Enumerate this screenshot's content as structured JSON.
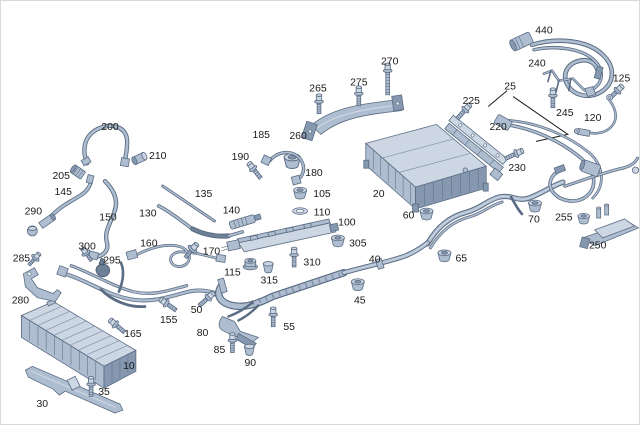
{
  "diagram": {
    "type": "exploded-parts-diagram",
    "colors": {
      "bg": "#ffffff",
      "label_color": "#1a1a1a",
      "leader_color": "#1a1a1a",
      "part_fill_light": "#ccd7e3",
      "part_fill_mid": "#aebdd0",
      "part_fill_dark": "#8598b0",
      "part_fill_darker": "#6e8096",
      "part_stroke": "#5a6c83",
      "hole_fill": "#eef2f6"
    },
    "callouts": [
      {
        "id": "440",
        "x": 545,
        "y": 29
      },
      {
        "id": "240",
        "x": 538,
        "y": 62
      },
      {
        "id": "270",
        "x": 390,
        "y": 60
      },
      {
        "id": "125",
        "x": 623,
        "y": 77
      },
      {
        "id": "275",
        "x": 359,
        "y": 81
      },
      {
        "id": "265",
        "x": 318,
        "y": 87
      },
      {
        "id": "25",
        "x": 511,
        "y": 85
      },
      {
        "id": "225",
        "x": 472,
        "y": 100
      },
      {
        "id": "245",
        "x": 566,
        "y": 112
      },
      {
        "id": "120",
        "x": 594,
        "y": 117
      },
      {
        "id": "220",
        "x": 499,
        "y": 126
      },
      {
        "id": "185",
        "x": 261,
        "y": 134
      },
      {
        "id": "260",
        "x": 298,
        "y": 135
      },
      {
        "id": "200",
        "x": 109,
        "y": 126
      },
      {
        "id": "190",
        "x": 240,
        "y": 156
      },
      {
        "id": "210",
        "x": 157,
        "y": 155
      },
      {
        "id": "230",
        "x": 518,
        "y": 167
      },
      {
        "id": "180",
        "x": 314,
        "y": 172
      },
      {
        "id": "205",
        "x": 60,
        "y": 175
      },
      {
        "id": "145",
        "x": 62,
        "y": 191
      },
      {
        "id": "135",
        "x": 203,
        "y": 193
      },
      {
        "id": "105",
        "x": 322,
        "y": 193
      },
      {
        "id": "20",
        "x": 379,
        "y": 193
      },
      {
        "id": "290",
        "x": 32,
        "y": 211
      },
      {
        "id": "150",
        "x": 107,
        "y": 217
      },
      {
        "id": "130",
        "x": 147,
        "y": 213
      },
      {
        "id": "140",
        "x": 231,
        "y": 210
      },
      {
        "id": "110",
        "x": 322,
        "y": 212
      },
      {
        "id": "100",
        "x": 347,
        "y": 222
      },
      {
        "id": "60",
        "x": 409,
        "y": 215
      },
      {
        "id": "70",
        "x": 535,
        "y": 219
      },
      {
        "id": "255",
        "x": 565,
        "y": 217
      },
      {
        "id": "300",
        "x": 86,
        "y": 246
      },
      {
        "id": "160",
        "x": 148,
        "y": 243
      },
      {
        "id": "305",
        "x": 358,
        "y": 243
      },
      {
        "id": "250",
        "x": 599,
        "y": 245
      },
      {
        "id": "285",
        "x": 20,
        "y": 258
      },
      {
        "id": "295",
        "x": 111,
        "y": 260
      },
      {
        "id": "170",
        "x": 211,
        "y": 251
      },
      {
        "id": "310",
        "x": 312,
        "y": 262
      },
      {
        "id": "40",
        "x": 375,
        "y": 259
      },
      {
        "id": "65",
        "x": 462,
        "y": 258
      },
      {
        "id": "115",
        "x": 232,
        "y": 272
      },
      {
        "id": "315",
        "x": 269,
        "y": 280
      },
      {
        "id": "280",
        "x": 19,
        "y": 300
      },
      {
        "id": "45",
        "x": 360,
        "y": 300
      },
      {
        "id": "50",
        "x": 196,
        "y": 310
      },
      {
        "id": "155",
        "x": 168,
        "y": 320
      },
      {
        "id": "55",
        "x": 289,
        "y": 327
      },
      {
        "id": "80",
        "x": 202,
        "y": 333
      },
      {
        "id": "165",
        "x": 132,
        "y": 334
      },
      {
        "id": "85",
        "x": 219,
        "y": 350
      },
      {
        "id": "90",
        "x": 250,
        "y": 363
      },
      {
        "id": "10",
        "x": 128,
        "y": 366
      },
      {
        "id": "35",
        "x": 103,
        "y": 392
      },
      {
        "id": "30",
        "x": 41,
        "y": 404
      }
    ]
  }
}
